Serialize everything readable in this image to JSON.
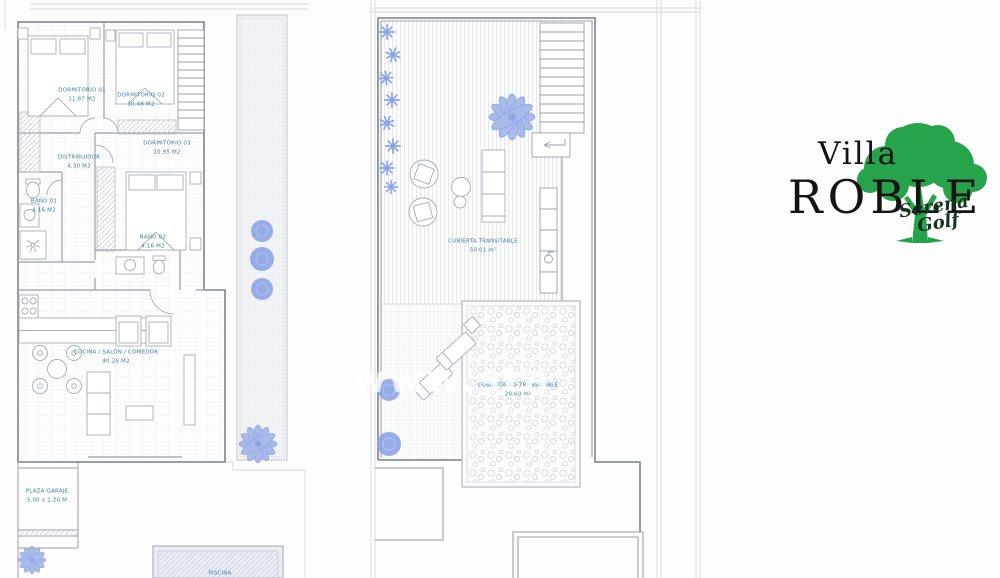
{
  "watermark": {
    "text": "www.sta"
  },
  "logo": {
    "villa": "Villa",
    "roble": "ROBLE",
    "script_line1": "Serena",
    "script_line2": "Golf",
    "tree_color": "#27a34c",
    "text_color": "#141414"
  },
  "colors": {
    "room_label": "#3d7ea8",
    "vegetation_blue": "#8ba3e6",
    "pool_fill": "#e9edf5",
    "wall_gray": "#8b919b"
  },
  "ground_floor": {
    "rooms": [
      {
        "label": "DORMITORIO 01",
        "area": "11.87 M2"
      },
      {
        "label": "DORMITORIO 02",
        "area": "10.48 M2"
      },
      {
        "label": "DORMITORIO 03",
        "area": "10.95 M2"
      },
      {
        "label": "DISTRIBUIDOR",
        "area": "4.30 M2"
      },
      {
        "label": "BAÑO 01",
        "area": "4.16 M2"
      },
      {
        "label": "BAÑO 02",
        "area": "4.16 M2"
      },
      {
        "label": "COCINA / SALÓN / COMEDOR",
        "area": "40.26 M2"
      },
      {
        "label": "PLAZA GARAJE",
        "area": "5.00 x 2.20 M"
      },
      {
        "label": "PISCINA",
        "area": ""
      }
    ]
  },
  "roof": {
    "rooms": [
      {
        "label": "CUBIERTA TRANSITABLE",
        "area": "50.01 m²"
      },
      {
        "label": "CUBIERTA NO TRANSITABLE",
        "area": "20.60 m²"
      }
    ]
  }
}
